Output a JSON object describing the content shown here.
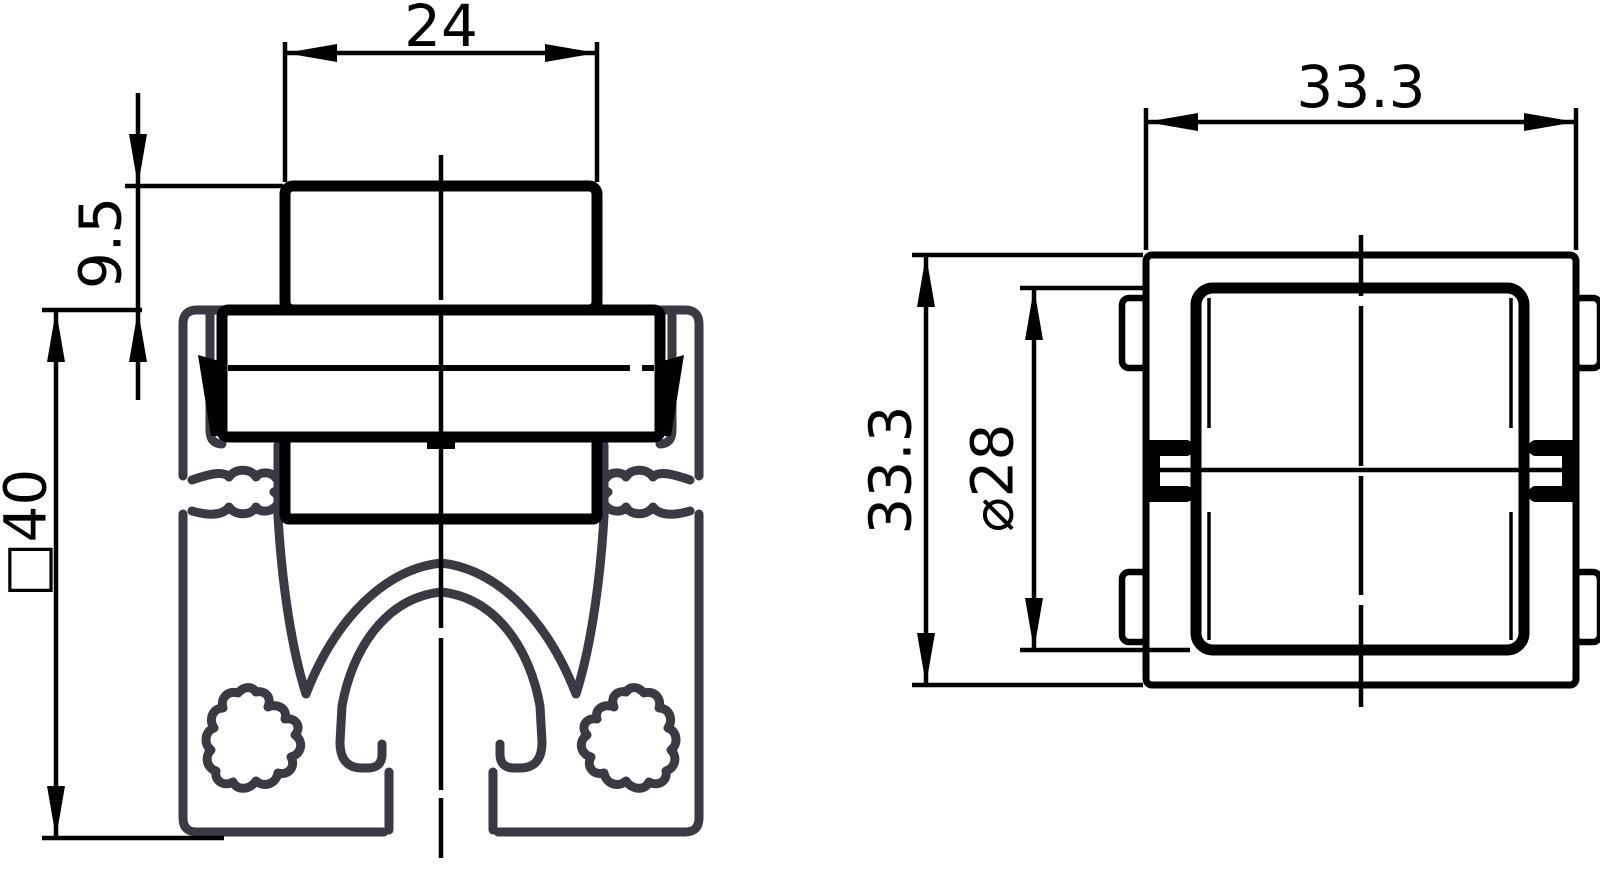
{
  "drawing": {
    "front_view": {
      "label": "profile cross-section with slot insert",
      "dim_width_top": "24",
      "dim_height_protrusion": "9.5",
      "dim_profile_square": "□40"
    },
    "side_view": {
      "label": "insert face view",
      "dim_width": "33.3",
      "dim_height": "33.3",
      "dim_diameter": "⌀28"
    },
    "style": {
      "part_line_color": "#000000",
      "profile_line_color": "#3a3a42",
      "background": "#ffffff"
    }
  }
}
